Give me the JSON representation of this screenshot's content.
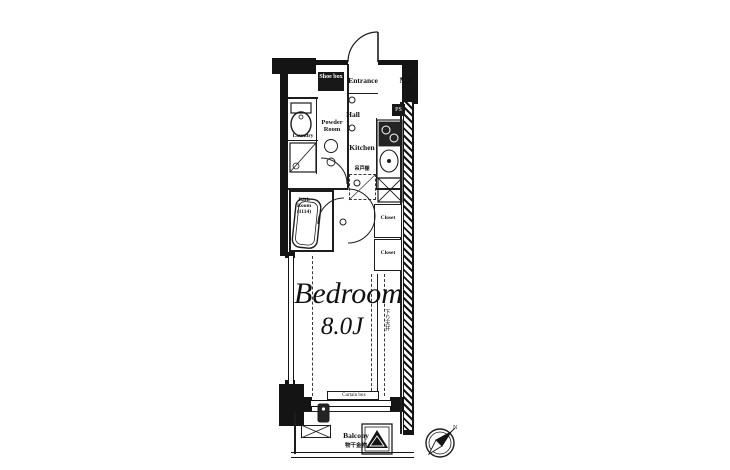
{
  "meta": {
    "type": "apartment-floor-plan"
  },
  "colors": {
    "wall": "#141414",
    "line": "#1d1d1d",
    "bg": "#ffffff"
  },
  "rooms": {
    "entrance": {
      "label": "Entrance"
    },
    "hall": {
      "label": "Hall"
    },
    "powder_room": {
      "label": "Powder Room"
    },
    "kitchen": {
      "label": "Kitchen"
    },
    "bath": {
      "label": "Bath Room",
      "size": "(1114)"
    },
    "bedroom": {
      "label": "Bedroom",
      "size": "8.0J"
    },
    "closet_upper": {
      "label": "Closet"
    },
    "closet_lower": {
      "label": "Closet"
    },
    "balcony": {
      "label": "Balcony",
      "note": "物干金物"
    }
  },
  "labels": {
    "meter_box": "MB",
    "pipe_space": "PS",
    "shoe_box": "Shoe box",
    "laundry": "Laundry",
    "curtain_box": "Curtain box",
    "lowered_ceiling": "下り天井",
    "hanging_cupboard": "吊戸棚",
    "compass_north": "N"
  }
}
